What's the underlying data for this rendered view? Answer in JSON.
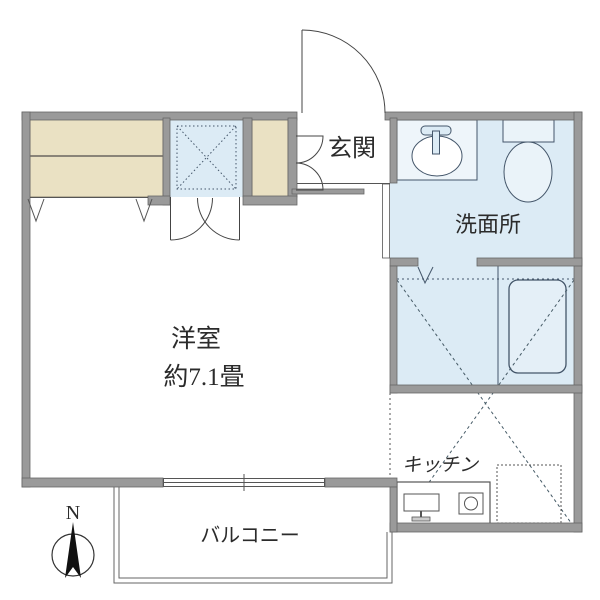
{
  "plan": {
    "type": "japanese-apartment-floor-plan",
    "labels": {
      "entrance": "玄関",
      "washroom": "洗面所",
      "western_room_name": "洋室",
      "western_room_size": "約7.1畳",
      "kitchen": "キッチン",
      "balcony": "バルコニー",
      "compass_north": "N"
    },
    "rooms": [
      {
        "name": "western-room",
        "label": "洋室",
        "size": "約7.1畳"
      },
      {
        "name": "entrance",
        "label": "玄関"
      },
      {
        "name": "washroom",
        "label": "洗面所"
      },
      {
        "name": "bathroom",
        "label": ""
      },
      {
        "name": "kitchen",
        "label": "キッチン"
      },
      {
        "name": "balcony",
        "label": "バルコニー"
      }
    ],
    "fixtures": [
      "closet-with-shelf",
      "washing-machine-space",
      "shoe-cabinet",
      "entrance-swing-door",
      "double-closet-doors",
      "washroom-sink",
      "toilet",
      "bathtub",
      "bath-folding-door",
      "kitchen-counter-sink",
      "stove-burner",
      "refrigerator-space-dashed",
      "sliding-window",
      "compass-north-arrow"
    ],
    "colors": {
      "wall": "#9a9a9a",
      "wall_edge": "#666666",
      "closet_fill": "#eae1c3",
      "wet_area_fill": "#dcebf5",
      "tub_fill": "#e4eff7",
      "fixture_line": "#44566a",
      "symbol_line": "#555555",
      "text": "#2b2b2b",
      "background": "#ffffff"
    }
  }
}
